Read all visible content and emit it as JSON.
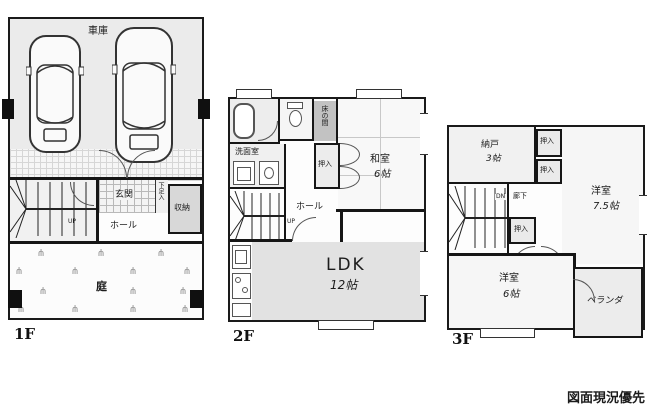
{
  "note": "図面現況優先",
  "floor1": {
    "label": "1F",
    "garage": "車庫",
    "entrance": "玄関",
    "shoe_cupboard": "下足入",
    "storage": "収納",
    "hall": "ホール",
    "garden": "庭",
    "up": "UP"
  },
  "floor2": {
    "label": "2F",
    "washroom": "洗面室",
    "tokonoma": "床の間",
    "closet": "押入",
    "japanese_room": "和室",
    "japanese_room_size": "6帖",
    "hall": "ホール",
    "up": "UP",
    "ldk": "LDK",
    "ldk_size": "12帖"
  },
  "floor3": {
    "label": "3F",
    "storeroom": "納戸",
    "storeroom_size": "3帖",
    "closet_top": "押入",
    "closet_mid": "押入",
    "closet_lower": "押入",
    "down": "DN",
    "corridor": "廊下",
    "western_room_large": "洋室",
    "western_room_large_size": "7.5帖",
    "western_room_small": "洋室",
    "western_room_small_size": "6帖",
    "veranda": "ベランダ"
  }
}
